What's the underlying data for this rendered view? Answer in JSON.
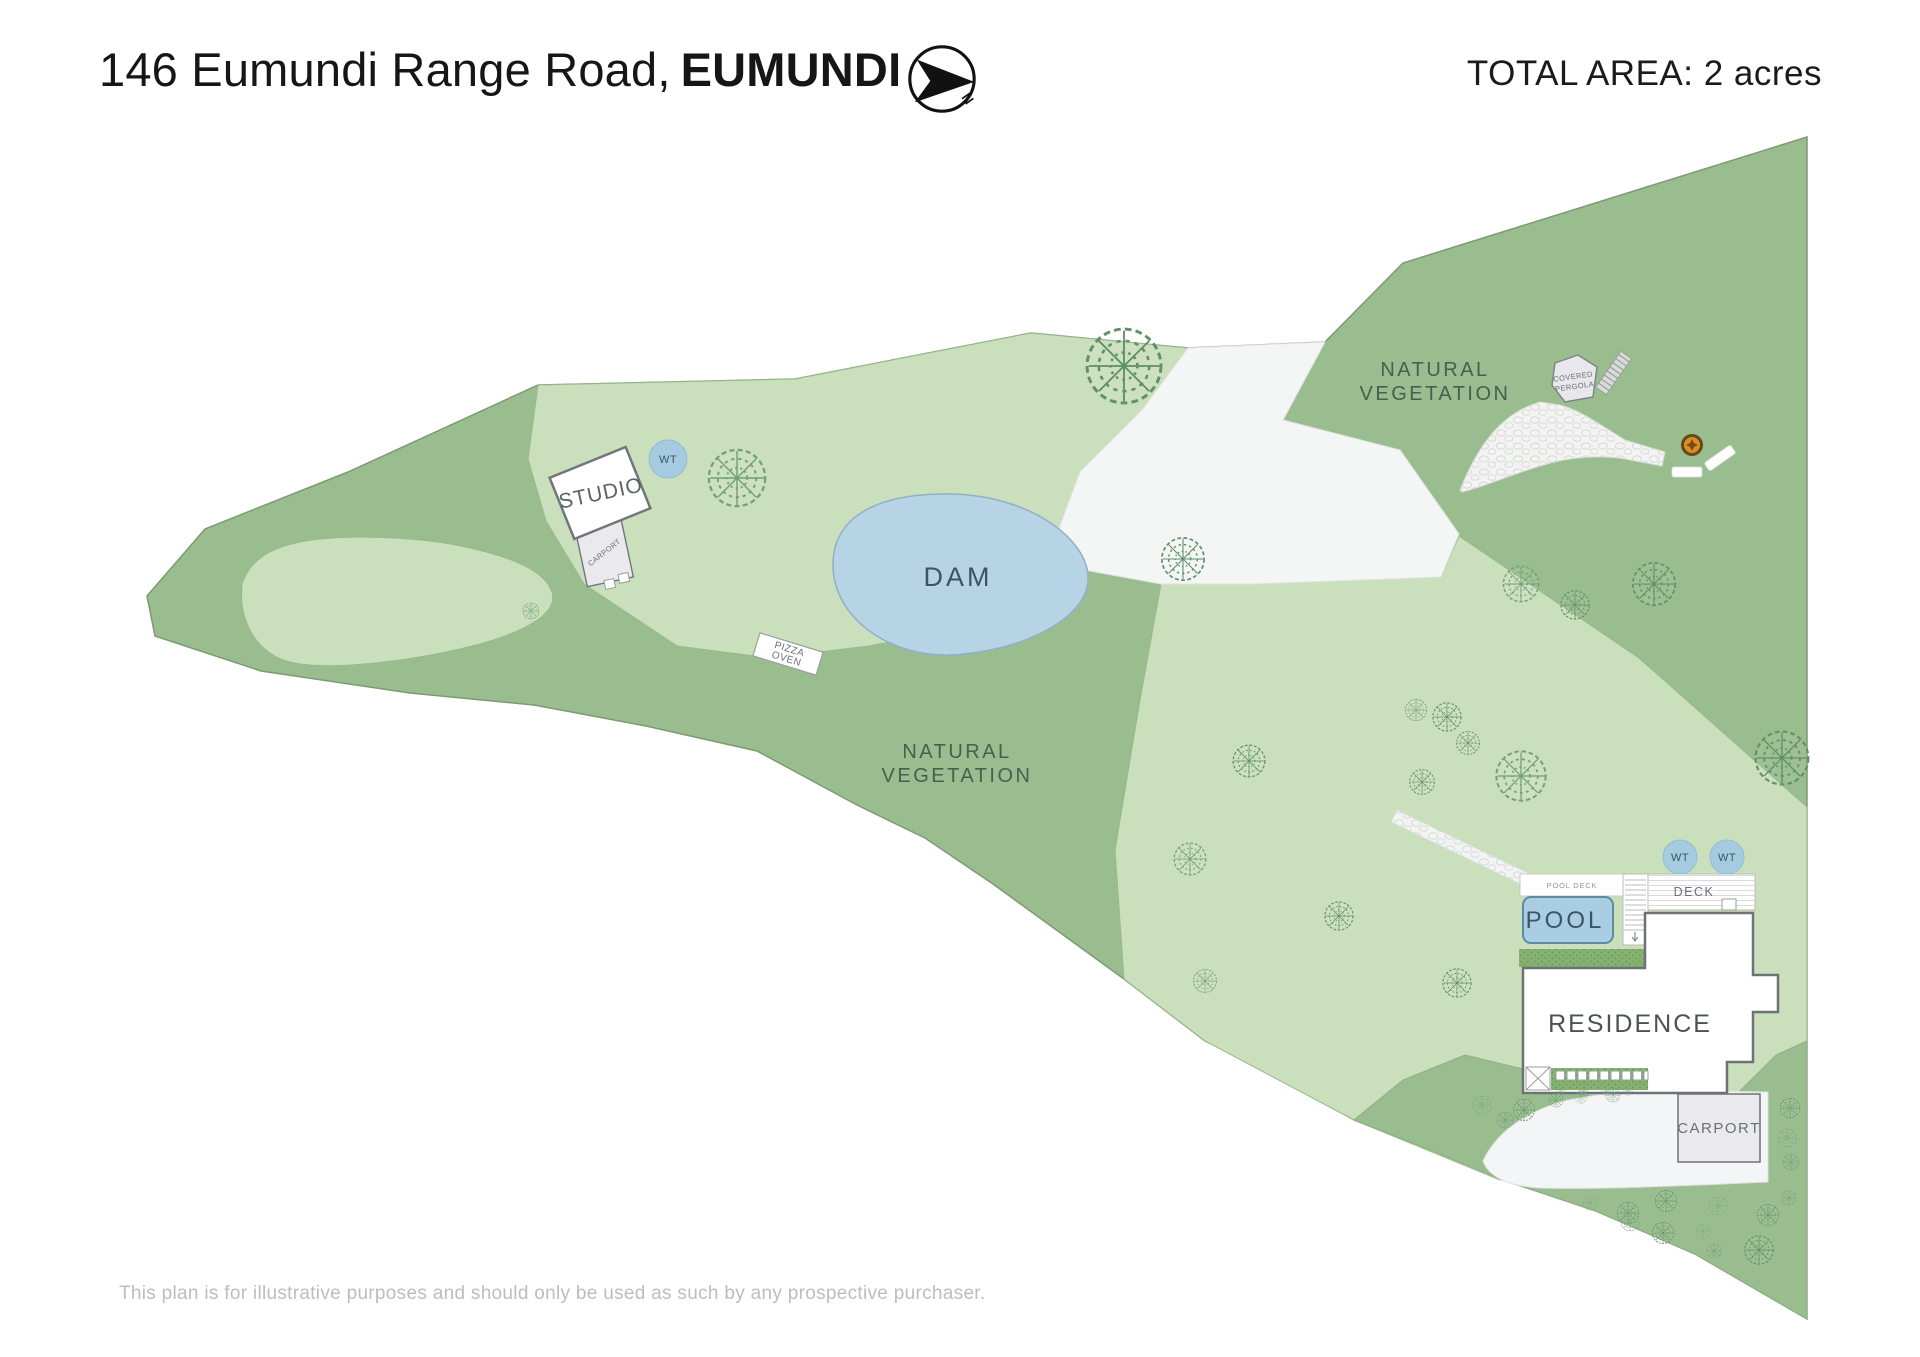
{
  "header": {
    "address_line": "146 Eumundi Range Road,",
    "address_suffix": "EUMUNDI",
    "total_area": "TOTAL AREA: 2 acres",
    "north": "N"
  },
  "map": {
    "labels": {
      "dam": "DAM",
      "natural_line1": "NATURAL",
      "natural_line2": "VEGETATION",
      "studio": "STUDIO",
      "studio_carport": "CARPORT",
      "pizza_line1": "PIZZA",
      "pizza_line2": "OVEN",
      "pergola_line1": "COVERED",
      "pergola_line2": "PERGOLA",
      "pool": "POOL",
      "pool_deck": "POOL DECK",
      "deck": "DECK",
      "residence": "RESIDENCE",
      "carport": "CARPORT",
      "water_tank": "WT"
    },
    "colors": {
      "field_green": "#9abd8f",
      "cleared_green": "#cadfbc",
      "dam_water": "#b7d3e6",
      "pool_water": "#a9cde2",
      "water_tank": "#a5cbe1",
      "path_white": "#f4f5f5",
      "tree_stroke": "#5f9066",
      "label_slate": "#3d5466",
      "fire_pit": "#d98f24"
    },
    "trees": [
      [
        737,
        478,
        32
      ],
      [
        1124,
        366,
        42
      ],
      [
        1183,
        559,
        24
      ],
      [
        1521,
        584,
        20
      ],
      [
        1575,
        605,
        16
      ],
      [
        1654,
        584,
        24
      ],
      [
        1521,
        776,
        28
      ],
      [
        1782,
        758,
        30
      ],
      [
        1447,
        717,
        16
      ],
      [
        1416,
        710,
        12
      ],
      [
        1468,
        743,
        13
      ],
      [
        1249,
        761,
        18
      ],
      [
        1190,
        859,
        18
      ],
      [
        1339,
        916,
        16
      ],
      [
        1457,
        983,
        16
      ],
      [
        1205,
        981,
        13
      ],
      [
        1422,
        782,
        14
      ],
      [
        531,
        611,
        9
      ],
      [
        1482,
        1105,
        10
      ],
      [
        1524,
        1110,
        12
      ],
      [
        1556,
        1100,
        8
      ],
      [
        1581,
        1097,
        7
      ],
      [
        1613,
        1095,
        8
      ],
      [
        1790,
        1108,
        11
      ],
      [
        1787,
        1138,
        10
      ],
      [
        1791,
        1162,
        9
      ],
      [
        1789,
        1198,
        8
      ],
      [
        1590,
        1203,
        8
      ],
      [
        1628,
        1213,
        12
      ],
      [
        1666,
        1201,
        12
      ],
      [
        1718,
        1206,
        10
      ],
      [
        1768,
        1215,
        12
      ],
      [
        1663,
        1233,
        12
      ],
      [
        1703,
        1231,
        8
      ],
      [
        1714,
        1251,
        8
      ],
      [
        1759,
        1250,
        16
      ],
      [
        1630,
        1222,
        10
      ],
      [
        1561,
        1090,
        5
      ],
      [
        1584,
        1091,
        5
      ],
      [
        1606,
        1091,
        5
      ],
      [
        1628,
        1091,
        5
      ],
      [
        1505,
        1120,
        9
      ]
    ]
  },
  "footer": {
    "disclaimer": "This plan is for illustrative purposes and should only be used as such by any prospective purchaser."
  }
}
